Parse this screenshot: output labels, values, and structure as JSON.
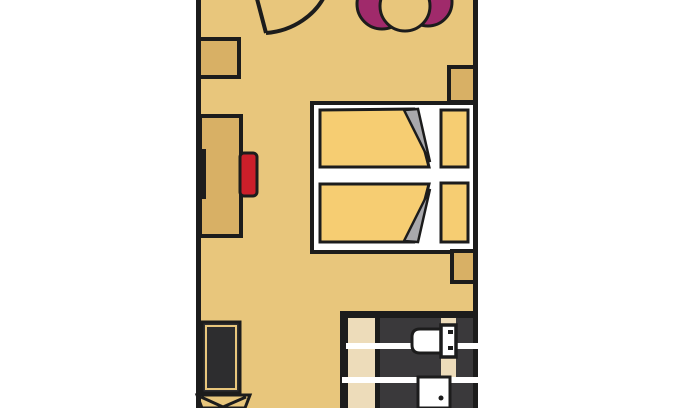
{
  "page": {
    "kind": "hotel-room-floor-plan",
    "background": "#ffffff"
  },
  "colors": {
    "outline": "#1c1c1c",
    "floor_tan": "#e8c67c",
    "furniture_tan": "#d8b065",
    "bedding_yellow": "#f6cd72",
    "fold_gray": "#a8a8ac",
    "frame_white": "#ffffff",
    "chair_red": "#cc1f2a",
    "terrace_magenta": "#a02a6b",
    "bathroom_floor_dark": "#3a393b",
    "vanity_beige": "#eddcba",
    "dark_unit": "#2d2d2f",
    "stripe_white": "#ffffff"
  },
  "elements": {
    "entry_door": "door-swing",
    "terrace_set": "two-chairs-and-round-table",
    "left_wall_units": [
      "wardrobe",
      "desk-with-red-chair",
      "wall-tv-panel",
      "dark-luggage-unit",
      "chair"
    ],
    "bed": "double-bed-two-duvets-two-pillows",
    "nightstands": 2,
    "bathroom": [
      "vanity-counter",
      "toilet-with-cistern",
      "door-with-handle"
    ]
  }
}
